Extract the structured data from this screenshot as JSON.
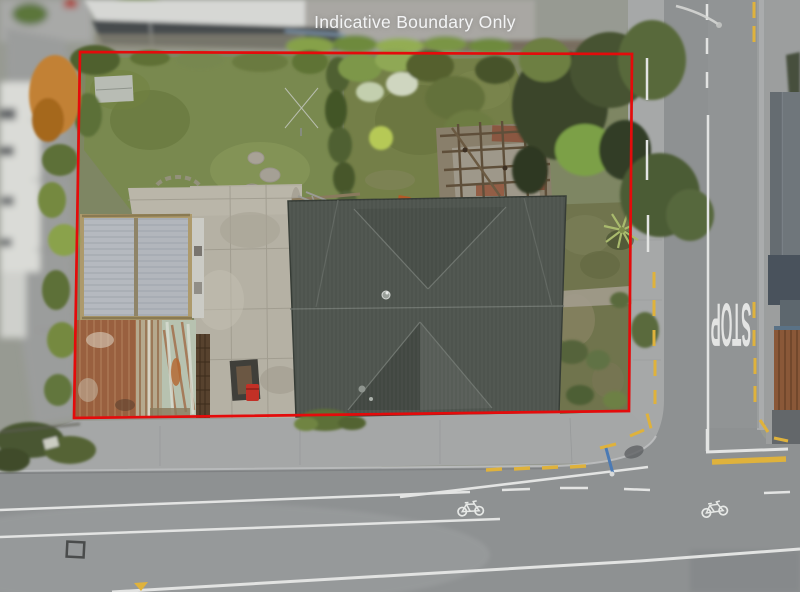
{
  "annotations": {
    "disclaimer_text": "Indicative Boundary Only",
    "disclaimer_color": "#f3f4f5",
    "boundary_color": "#e40b0b"
  },
  "road": {
    "stop_marking": "STOP",
    "marking_white": "#e3e4e3",
    "no_stopping_yellow": "#dfb23c",
    "centerline_white": "#e2e3e2"
  },
  "icons": {
    "bicycle_symbol": "bicycle-lane-marking"
  },
  "scene": {
    "house_roof_color": "#4e544e",
    "garage_roof_color": "#b5b9bf",
    "rust_shed_color": "#99603f",
    "lawn_color": "#79894f",
    "asphalt_color": "#8e9192",
    "red_bin_color": "#c23026"
  }
}
